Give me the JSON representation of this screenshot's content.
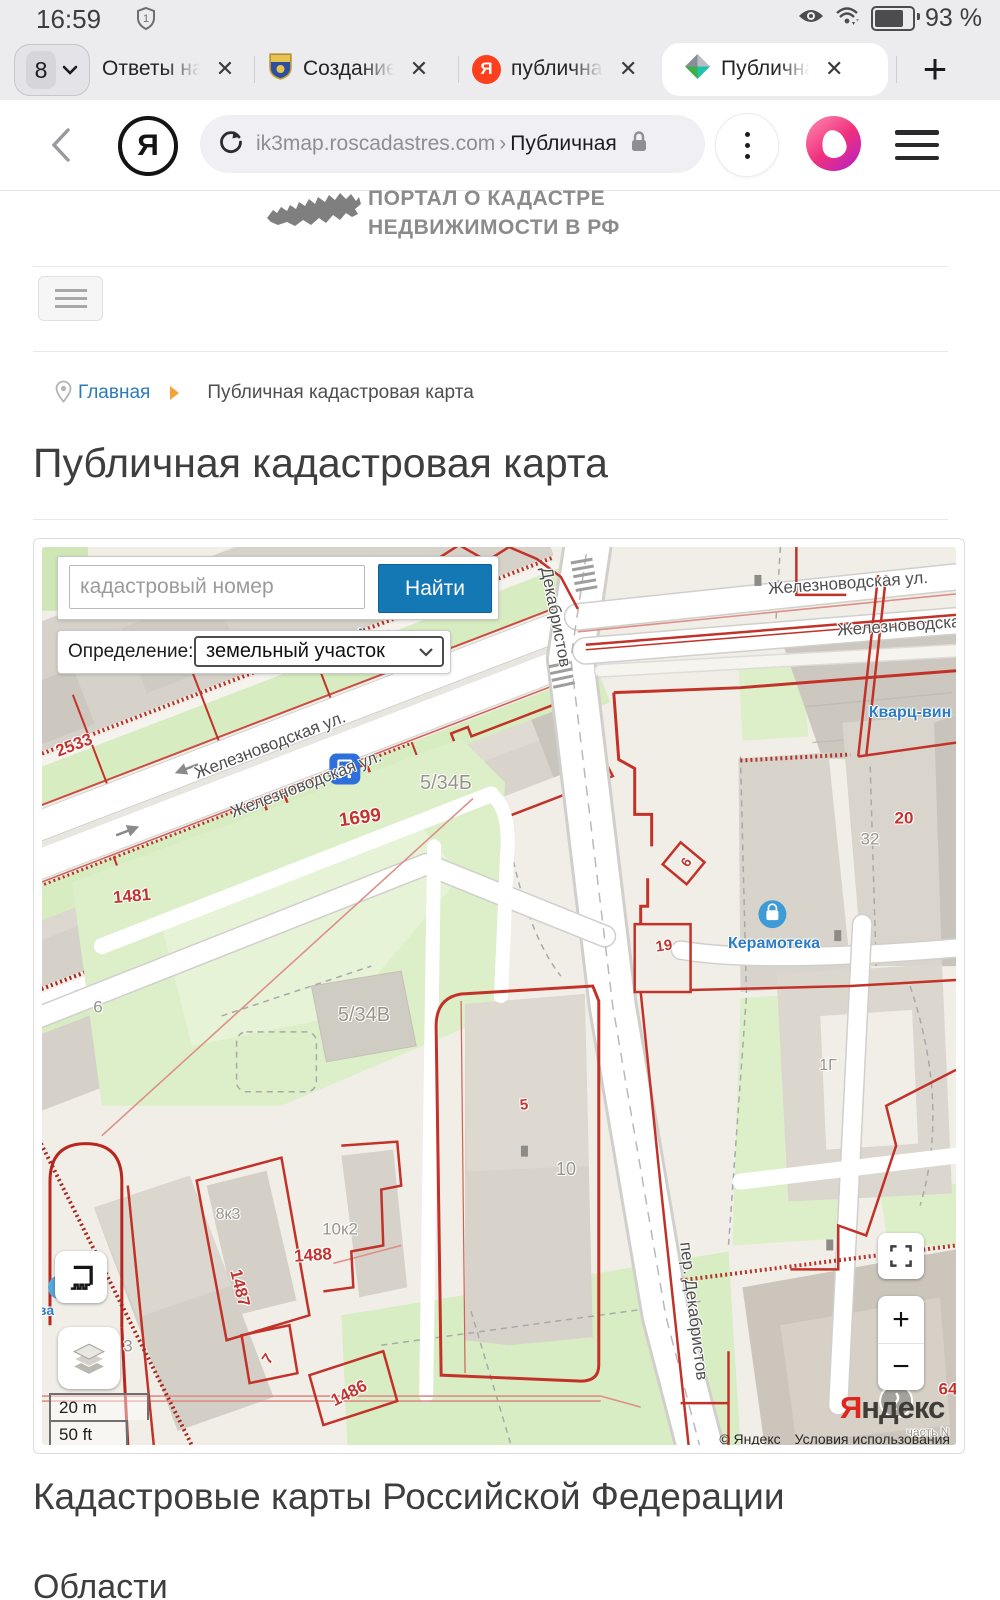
{
  "status_bar": {
    "time": "16:59",
    "sim_badge": "1",
    "battery_percent": "93 %"
  },
  "tab_bar": {
    "count": "8",
    "close_glyph": "✕",
    "new_tab_glyph": "+",
    "tabs": [
      {
        "label": "Ответы на"
      },
      {
        "label": "Создание",
        "icon": "lsn-shield"
      },
      {
        "label": "публичная",
        "icon": "yandex-red"
      },
      {
        "label": "Публична",
        "icon": "pkk-pinwheel"
      }
    ]
  },
  "address_bar": {
    "domain": "ik3map.roscadastres.com",
    "separator": "›",
    "page": "Публичная"
  },
  "portal_header": {
    "line1": "ПОРТАЛ О КАДАСТРЕ",
    "line2": "НЕДВИЖИМОСТИ В РФ"
  },
  "breadcrumb": {
    "home": "Главная",
    "current": "Публичная кадастровая карта"
  },
  "page": {
    "title": "Публичная кадастровая карта",
    "section_heading": "Кадастровые карты Российской Федерации",
    "section_subheading": "Области"
  },
  "map": {
    "search": {
      "placeholder": "кадастровый номер",
      "button_label": "Найти"
    },
    "definition": {
      "label": "Определение:",
      "value": "земельный участок"
    },
    "controls": {
      "zoom_in": "+",
      "zoom_out": "−"
    },
    "scale": {
      "metric": "20 m",
      "imperial": "50 ft"
    },
    "attribution": {
      "copyright": "© Яндекс",
      "terms_link": "Условия использования"
    },
    "logo": {
      "ya": "Я",
      "rest": "ндекс"
    },
    "colors": {
      "parcel_red": "#c23229",
      "street_label": "#4e4e4e",
      "building_label": "#98938a",
      "poi_blue": "#2d7cc3",
      "accent_blue": "#1478b5"
    },
    "labels": [
      {
        "text": "Железноводская ул.",
        "type": "street"
      },
      {
        "text": "Железноводская ул.",
        "type": "street"
      },
      {
        "text": "Железноводская ул.",
        "type": "street"
      },
      {
        "text": "Железноводская у",
        "type": "street"
      },
      {
        "text": "Декабристов",
        "type": "street"
      },
      {
        "text": "пер. Декабристов",
        "type": "street"
      },
      {
        "text": "2533",
        "type": "red"
      },
      {
        "text": "1699",
        "type": "red"
      },
      {
        "text": "1481",
        "type": "red"
      },
      {
        "text": "5/34Б",
        "type": "bld"
      },
      {
        "text": "5/34В",
        "type": "bld"
      },
      {
        "text": "8к3",
        "type": "bld"
      },
      {
        "text": "10к2",
        "type": "bld"
      },
      {
        "text": "1488",
        "type": "red"
      },
      {
        "text": "1487",
        "type": "red"
      },
      {
        "text": "1486",
        "type": "red"
      },
      {
        "text": "7",
        "type": "red"
      },
      {
        "text": "3",
        "type": "bld"
      },
      {
        "text": "6",
        "type": "bld"
      },
      {
        "text": "5",
        "type": "red"
      },
      {
        "text": "10",
        "type": "bld"
      },
      {
        "text": "19",
        "type": "red"
      },
      {
        "text": "6",
        "type": "red"
      },
      {
        "text": "20",
        "type": "red"
      },
      {
        "text": "32",
        "type": "bld"
      },
      {
        "text": "1Г",
        "type": "bld"
      },
      {
        "text": "Кварц-вин",
        "type": "poi"
      },
      {
        "text": "Керамотека",
        "type": "poi"
      },
      {
        "text": "64",
        "type": "red"
      },
      {
        "text": "часть N",
        "type": "bld"
      },
      {
        "text": "Астра",
        "type": "poi"
      },
      {
        "text": "ва",
        "type": "poi"
      }
    ]
  }
}
